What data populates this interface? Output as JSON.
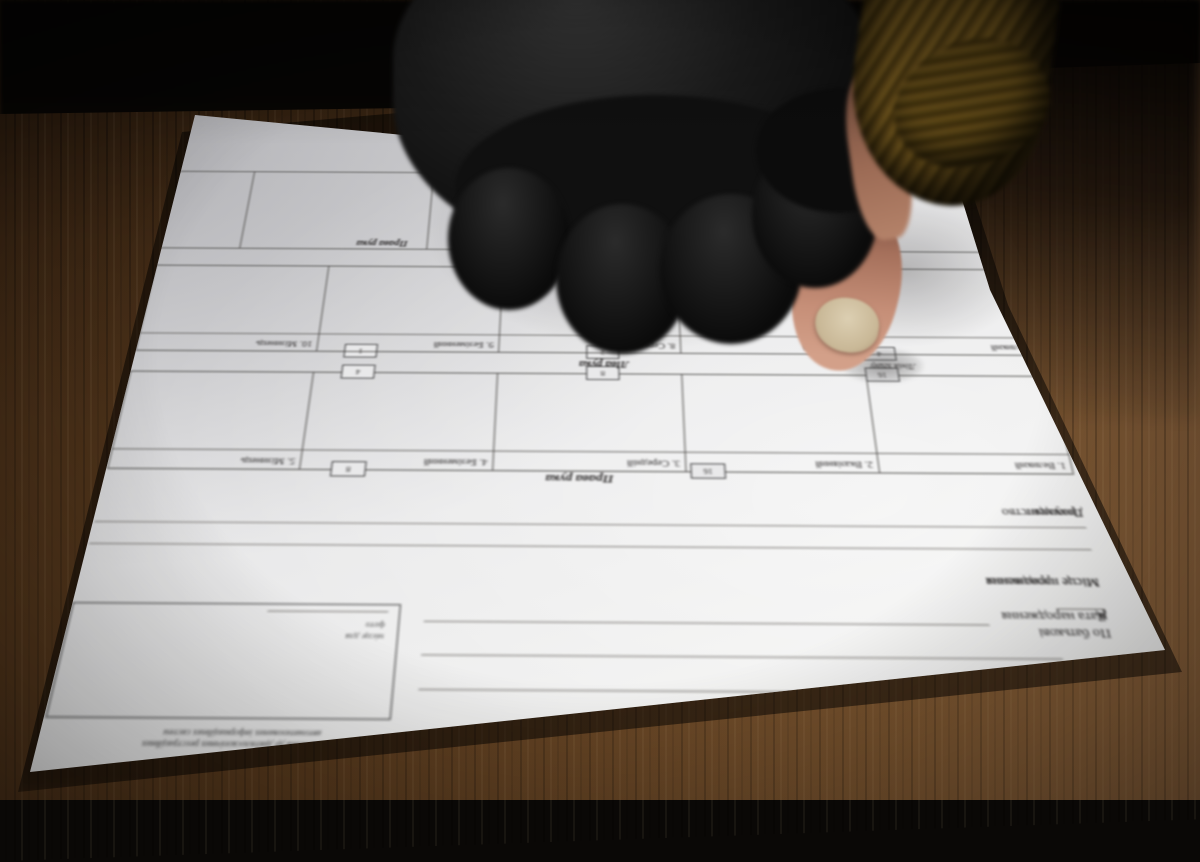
{
  "form": {
    "title_caption": "(підпис)",
    "fields": {
      "surname": "Прізвище",
      "first_name": "Ім'я",
      "patronymic": "По батькові",
      "birth_date": "Дата народження",
      "quote_open": "«",
      "quote_close": "»",
      "year_suffix": "р.",
      "birth_place": "Місце народження",
      "residence": "Місце проживання",
      "citizenship": "Громадянство",
      "document": "Документ"
    },
    "photo_area": {
      "note_title": "Відмітка *",
      "note_line1": "про внесення до дактилоскопічних реєстраційних",
      "note_line2": "автоматизованих інформаційних систем",
      "photo_caption_line1": "місце для",
      "photo_caption_line2": "фото"
    },
    "sections": {
      "right_hand": "Права рука",
      "left_hand": "Ліва рука",
      "fold_line": "Лінія згину",
      "control_prints": "Контрольні відбитки",
      "control_thumb": "Великий",
      "control_right_hand": "Права рука"
    },
    "right_hand_fingers": [
      "1. Великий",
      "2. Вказівний",
      "3. Середній",
      "4. Безіменний",
      "5. Мізинець"
    ],
    "left_hand_fingers": [
      "6. Великий",
      "7. Вказівний",
      "8. Середній",
      "9. Безіменний",
      "10. Мізинець"
    ],
    "fold_tabs": {
      "top_edge_left": "16",
      "top_edge_right": "8",
      "fold_left_top": "16",
      "fold_left_bottom": "4",
      "fold_center_top": "8",
      "fold_center_bottom": "2",
      "fold_right_top": "4",
      "fold_right_bottom": "1"
    }
  },
  "colors": {
    "paper": "#ececeb",
    "ink": "#2e2c2c",
    "glove_black": "#0e0e0e",
    "sleeve_olive": "#6b5626",
    "skin": "#c68f78",
    "nail": "#cdbc9c",
    "wood_brown": "#5a3c20",
    "background_dark": "#060504"
  }
}
